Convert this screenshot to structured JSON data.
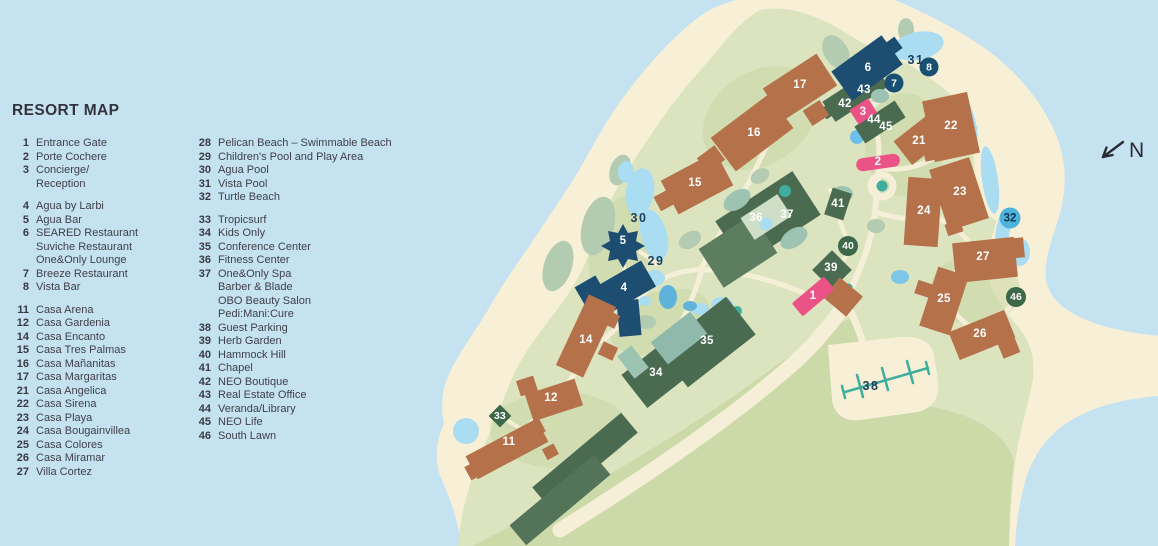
{
  "legend": {
    "title": "RESORT MAP",
    "col1": [
      {
        "num": "1",
        "lines": [
          "Entrance Gate"
        ]
      },
      {
        "num": "2",
        "lines": [
          "Porte Cochere"
        ]
      },
      {
        "num": "3",
        "lines": [
          "Concierge/",
          "Reception"
        ]
      },
      {
        "gap": true
      },
      {
        "num": "4",
        "lines": [
          "Agua by Larbi"
        ]
      },
      {
        "num": "5",
        "lines": [
          "Agua Bar"
        ]
      },
      {
        "num": "6",
        "lines": [
          "SEARED Restaurant",
          "Suviche Restaurant",
          "One&Only Lounge"
        ]
      },
      {
        "num": "7",
        "lines": [
          "Breeze Restaurant"
        ]
      },
      {
        "num": "8",
        "lines": [
          "Vista Bar"
        ]
      },
      {
        "gap": true
      },
      {
        "num": "11",
        "lines": [
          "Casa Arena"
        ]
      },
      {
        "num": "12",
        "lines": [
          "Casa Gardenia"
        ]
      },
      {
        "num": "14",
        "lines": [
          "Casa Encanto"
        ]
      },
      {
        "num": "15",
        "lines": [
          "Casa Tres Palmas"
        ]
      },
      {
        "num": "16",
        "lines": [
          "Casa Mañanitas"
        ]
      },
      {
        "num": "17",
        "lines": [
          "Casa Margaritas"
        ]
      },
      {
        "num": "21",
        "lines": [
          "Casa Angelica"
        ]
      },
      {
        "num": "22",
        "lines": [
          "Casa Sirena"
        ]
      },
      {
        "num": "23",
        "lines": [
          "Casa Playa"
        ]
      },
      {
        "num": "24",
        "lines": [
          "Casa Bougainvillea"
        ]
      },
      {
        "num": "25",
        "lines": [
          "Casa Colores"
        ]
      },
      {
        "num": "26",
        "lines": [
          "Casa Miramar"
        ]
      },
      {
        "num": "27",
        "lines": [
          "Villa Cortez"
        ]
      }
    ],
    "col2": [
      {
        "num": "28",
        "lines": [
          "Pelican Beach – Swimmable Beach"
        ]
      },
      {
        "num": "29",
        "lines": [
          "Children's Pool and Play Area"
        ]
      },
      {
        "num": "30",
        "lines": [
          "Agua Pool"
        ]
      },
      {
        "num": "31",
        "lines": [
          "Vista Pool"
        ]
      },
      {
        "num": "32",
        "lines": [
          "Turtle Beach"
        ]
      },
      {
        "gap": true
      },
      {
        "num": "33",
        "lines": [
          "Tropicsurf"
        ]
      },
      {
        "num": "34",
        "lines": [
          "Kids Only"
        ]
      },
      {
        "num": "35",
        "lines": [
          "Conference Center"
        ]
      },
      {
        "num": "36",
        "lines": [
          "Fitness Center"
        ]
      },
      {
        "num": "37",
        "lines": [
          "One&Only Spa",
          "Barber & Blade",
          "OBO Beauty Salon",
          "Pedi:Mani:Cure"
        ]
      },
      {
        "num": "38",
        "lines": [
          "Guest Parking"
        ]
      },
      {
        "num": "39",
        "lines": [
          "Herb Garden"
        ]
      },
      {
        "num": "40",
        "lines": [
          "Hammock Hill"
        ]
      },
      {
        "num": "41",
        "lines": [
          "Chapel"
        ]
      },
      {
        "num": "42",
        "lines": [
          "NEO Boutique"
        ]
      },
      {
        "num": "43",
        "lines": [
          "Real Estate Office"
        ]
      },
      {
        "num": "44",
        "lines": [
          "Veranda/Library"
        ]
      },
      {
        "num": "45",
        "lines": [
          "NEO Life"
        ]
      },
      {
        "num": "46",
        "lines": [
          "South Lawn"
        ]
      }
    ]
  },
  "markers": [
    {
      "n": "1",
      "x": 813,
      "y": 296,
      "t": "light"
    },
    {
      "n": "2",
      "x": 878,
      "y": 162,
      "t": "light"
    },
    {
      "n": "3",
      "x": 863,
      "y": 112,
      "t": "light"
    },
    {
      "n": "4",
      "x": 624,
      "y": 288,
      "t": "light"
    },
    {
      "n": "5",
      "x": 623,
      "y": 241,
      "t": "light"
    },
    {
      "n": "6",
      "x": 868,
      "y": 68,
      "t": "light"
    },
    {
      "n": "7",
      "x": 894,
      "y": 83,
      "t": "circle-navy"
    },
    {
      "n": "8",
      "x": 929,
      "y": 67,
      "t": "circle-navy"
    },
    {
      "n": "11",
      "x": 509,
      "y": 442,
      "t": "light"
    },
    {
      "n": "12",
      "x": 551,
      "y": 398,
      "t": "light"
    },
    {
      "n": "14",
      "x": 586,
      "y": 340,
      "t": "light"
    },
    {
      "n": "15",
      "x": 695,
      "y": 183,
      "t": "light"
    },
    {
      "n": "16",
      "x": 754,
      "y": 133,
      "t": "light"
    },
    {
      "n": "17",
      "x": 800,
      "y": 85,
      "t": "light"
    },
    {
      "n": "21",
      "x": 919,
      "y": 141,
      "t": "light"
    },
    {
      "n": "22",
      "x": 951,
      "y": 126,
      "t": "light"
    },
    {
      "n": "23",
      "x": 960,
      "y": 192,
      "t": "light"
    },
    {
      "n": "24",
      "x": 924,
      "y": 211,
      "t": "light"
    },
    {
      "n": "25",
      "x": 944,
      "y": 299,
      "t": "light"
    },
    {
      "n": "26",
      "x": 980,
      "y": 334,
      "t": "light"
    },
    {
      "n": "27",
      "x": 983,
      "y": 257,
      "t": "light"
    },
    {
      "n": "29",
      "x": 656,
      "y": 261,
      "t": "dark"
    },
    {
      "n": "30",
      "x": 639,
      "y": 218,
      "t": "dark"
    },
    {
      "n": "31",
      "x": 916,
      "y": 60,
      "t": "dark"
    },
    {
      "n": "32",
      "x": 1010,
      "y": 218,
      "t": "circle-blue"
    },
    {
      "n": "33",
      "x": 500,
      "y": 416,
      "t": "diamond-green"
    },
    {
      "n": "34",
      "x": 656,
      "y": 373,
      "t": "light"
    },
    {
      "n": "35",
      "x": 707,
      "y": 341,
      "t": "light"
    },
    {
      "n": "36",
      "x": 756,
      "y": 218,
      "t": "light"
    },
    {
      "n": "37",
      "x": 787,
      "y": 215,
      "t": "light"
    },
    {
      "n": "38",
      "x": 871,
      "y": 386,
      "t": "dark"
    },
    {
      "n": "39",
      "x": 831,
      "y": 268,
      "t": "light"
    },
    {
      "n": "40",
      "x": 848,
      "y": 246,
      "t": "circle-green"
    },
    {
      "n": "41",
      "x": 838,
      "y": 204,
      "t": "light"
    },
    {
      "n": "42",
      "x": 845,
      "y": 104,
      "t": "light"
    },
    {
      "n": "43",
      "x": 864,
      "y": 90,
      "t": "light"
    },
    {
      "n": "44",
      "x": 874,
      "y": 120,
      "t": "light"
    },
    {
      "n": "45",
      "x": 886,
      "y": 127,
      "t": "light"
    },
    {
      "n": "46",
      "x": 1016,
      "y": 297,
      "t": "circle-green"
    }
  ],
  "north": {
    "label": "N"
  },
  "colors": {
    "water": "#c5e2f1",
    "sand": "#f7f0d6",
    "land": "#dbe4bf",
    "lawn": "#ccd9a8",
    "navy": "#1d4e72",
    "casa": "#b5714a",
    "bgreen": "#4b6b50",
    "sage": "#9dc3b2",
    "pink": "#eb5286",
    "pool": "#aadcf2",
    "teal": "#3fae9f",
    "marker_navy": "#175072",
    "marker_blue": "#4db3dc",
    "marker_green": "#3d6849",
    "text": "#35353f"
  }
}
